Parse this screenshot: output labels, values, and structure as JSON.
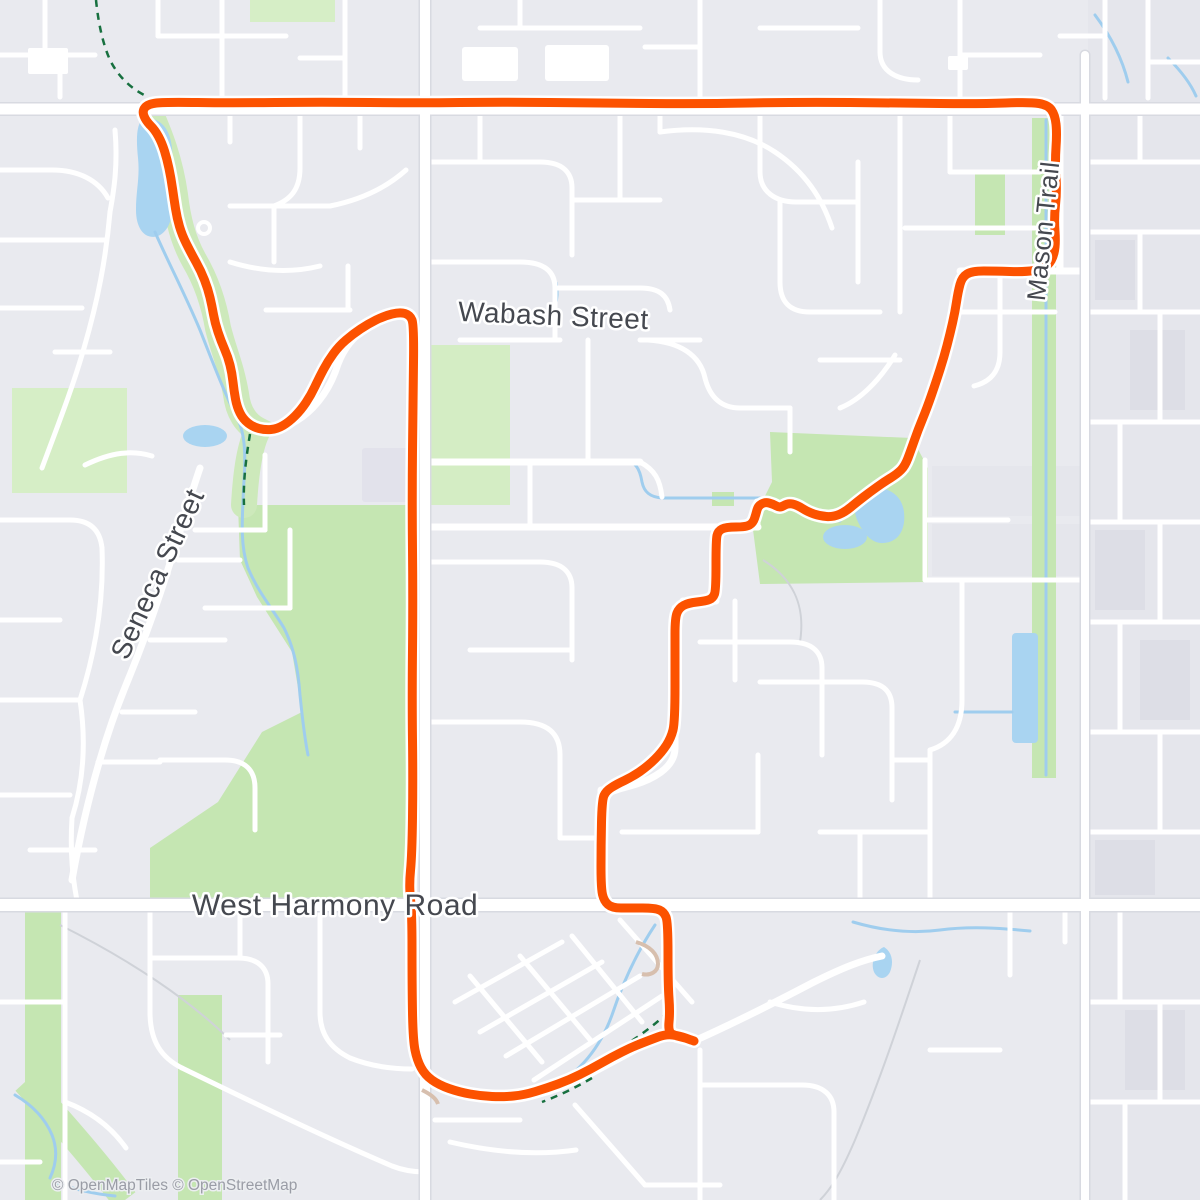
{
  "map": {
    "labels": [
      {
        "id": "wabash",
        "text": "Wabash Street"
      },
      {
        "id": "seneca",
        "text": "Seneca Street"
      },
      {
        "id": "harmony",
        "text": "West Harmony Road"
      },
      {
        "id": "mason",
        "text": "Mason Trail"
      }
    ],
    "attribution": "© OpenMapTiles © OpenStreetMap",
    "colors": {
      "background": "#e9eaef",
      "district": "#e5e6ec",
      "building": "#dddee6",
      "road_fill": "#ffffff",
      "road_casing": "#d8dae1",
      "park_green": "#c5e6b2",
      "park_green_light": "#d6eec6",
      "water_fill": "#a9d4f1",
      "stream": "#9fcdee",
      "trail_green": "#17703f",
      "path_tan": "#d7bfae",
      "faint_trail": "#cfd2d8",
      "route": "#fc5200",
      "route_casing": "#ffffff"
    },
    "route": {
      "color": "#fc5200",
      "points": [
        [
          694,
          1041
        ],
        [
          686,
          1038
        ],
        [
          676,
          1036
        ],
        [
          668,
          1032
        ],
        [
          670,
          1012
        ],
        [
          668,
          985
        ],
        [
          668,
          922
        ],
        [
          664,
          912
        ],
        [
          655,
          908
        ],
        [
          630,
          908
        ],
        [
          612,
          908
        ],
        [
          604,
          901
        ],
        [
          601,
          888
        ],
        [
          601,
          845
        ],
        [
          602,
          800
        ],
        [
          606,
          791
        ],
        [
          617,
          784
        ],
        [
          632,
          777
        ],
        [
          648,
          766
        ],
        [
          662,
          752
        ],
        [
          671,
          738
        ],
        [
          675,
          722
        ],
        [
          675,
          650
        ],
        [
          675,
          618
        ],
        [
          679,
          608
        ],
        [
          688,
          603
        ],
        [
          706,
          601
        ],
        [
          713,
          598
        ],
        [
          716,
          590
        ],
        [
          716,
          540
        ],
        [
          718,
          531
        ],
        [
          726,
          527
        ],
        [
          746,
          527
        ],
        [
          753,
          523
        ],
        [
          756,
          514
        ],
        [
          758,
          506
        ],
        [
          765,
          502
        ],
        [
          773,
          504
        ],
        [
          780,
          508
        ],
        [
          788,
          503
        ],
        [
          797,
          505
        ],
        [
          808,
          512
        ],
        [
          820,
          516
        ],
        [
          833,
          517
        ],
        [
          845,
          512
        ],
        [
          857,
          502
        ],
        [
          870,
          492
        ],
        [
          884,
          482
        ],
        [
          897,
          474
        ],
        [
          905,
          466
        ],
        [
          911,
          450
        ],
        [
          918,
          430
        ],
        [
          927,
          408
        ],
        [
          936,
          382
        ],
        [
          944,
          357
        ],
        [
          950,
          334
        ],
        [
          955,
          312
        ],
        [
          958,
          292
        ],
        [
          962,
          277
        ],
        [
          972,
          271
        ],
        [
          995,
          271
        ],
        [
          1025,
          272
        ],
        [
          1043,
          269
        ],
        [
          1052,
          261
        ],
        [
          1056,
          245
        ],
        [
          1054,
          218
        ],
        [
          1057,
          192
        ],
        [
          1055,
          162
        ],
        [
          1057,
          133
        ],
        [
          1055,
          115
        ],
        [
          1048,
          105
        ],
        [
          1030,
          102
        ],
        [
          980,
          104
        ],
        [
          900,
          103
        ],
        [
          800,
          102
        ],
        [
          700,
          104
        ],
        [
          600,
          103
        ],
        [
          500,
          102
        ],
        [
          420,
          103
        ],
        [
          320,
          102
        ],
        [
          230,
          103
        ],
        [
          165,
          102
        ],
        [
          148,
          104
        ],
        [
          142,
          111
        ],
        [
          146,
          121
        ],
        [
          155,
          130
        ],
        [
          162,
          143
        ],
        [
          167,
          159
        ],
        [
          171,
          178
        ],
        [
          174,
          199
        ],
        [
          177,
          218
        ],
        [
          182,
          235
        ],
        [
          191,
          253
        ],
        [
          201,
          271
        ],
        [
          208,
          289
        ],
        [
          212,
          306
        ],
        [
          215,
          323
        ],
        [
          221,
          341
        ],
        [
          228,
          357
        ],
        [
          232,
          373
        ],
        [
          234,
          391
        ],
        [
          237,
          407
        ],
        [
          243,
          419
        ],
        [
          253,
          427
        ],
        [
          265,
          430
        ],
        [
          277,
          429
        ],
        [
          289,
          422
        ],
        [
          301,
          410
        ],
        [
          311,
          395
        ],
        [
          319,
          378
        ],
        [
          328,
          361
        ],
        [
          339,
          346
        ],
        [
          353,
          334
        ],
        [
          368,
          324
        ],
        [
          384,
          316
        ],
        [
          400,
          312
        ],
        [
          410,
          315
        ],
        [
          414,
          325
        ],
        [
          413,
          400
        ],
        [
          412,
          500
        ],
        [
          413,
          600
        ],
        [
          412,
          700
        ],
        [
          413,
          780
        ],
        [
          412,
          855
        ],
        [
          409,
          886
        ],
        [
          412,
          912
        ],
        [
          412,
          985
        ],
        [
          413,
          1040
        ],
        [
          417,
          1060
        ],
        [
          425,
          1075
        ],
        [
          439,
          1085
        ],
        [
          459,
          1092
        ],
        [
          481,
          1096
        ],
        [
          503,
          1097
        ],
        [
          524,
          1095
        ],
        [
          547,
          1088
        ],
        [
          569,
          1080
        ],
        [
          591,
          1069
        ],
        [
          612,
          1057
        ],
        [
          632,
          1047
        ],
        [
          650,
          1040
        ],
        [
          666,
          1034
        ],
        [
          680,
          1036
        ],
        [
          691,
          1040
        ]
      ]
    }
  }
}
